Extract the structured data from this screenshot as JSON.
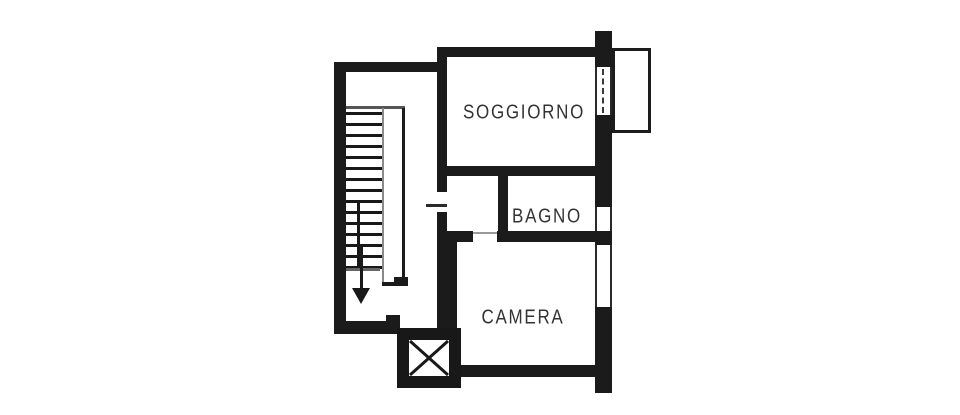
{
  "plan": {
    "rooms": [
      {
        "id": "soggiorno",
        "label": "SOGGIORNO"
      },
      {
        "id": "bagno",
        "label": "BAGNO"
      },
      {
        "id": "camera",
        "label": "CAMERA"
      }
    ],
    "features": [
      "staircase-down-arrow",
      "elevator-shaft",
      "balcony",
      "windows-right-wall",
      "door-stair-to-hall",
      "door-hall-to-camera"
    ],
    "colors": {
      "wall": "#1b1b1b",
      "background": "#ffffff",
      "rail_gray": "#8a8a8a",
      "label": "#333333"
    }
  }
}
